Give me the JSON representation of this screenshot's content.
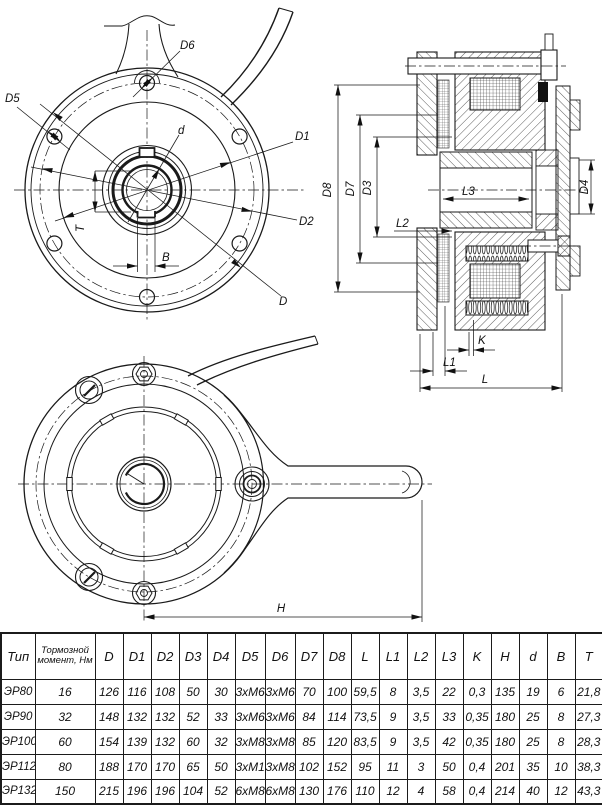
{
  "dim_labels": {
    "D": "D",
    "D1": "D1",
    "D2": "D2",
    "D3": "D3",
    "D4": "D4",
    "D5": "D5",
    "D6": "D6",
    "D7": "D7",
    "D8": "D8",
    "d": "d",
    "B": "B",
    "T": "T",
    "L": "L",
    "L1": "L1",
    "L2": "L2",
    "L3": "L3",
    "K": "K",
    "H": "H"
  },
  "table": {
    "col_headers": [
      "Тип",
      "Тормозной момент, Нм",
      "D",
      "D1",
      "D2",
      "D3",
      "D4",
      "D5",
      "D6",
      "D7",
      "D8",
      "L",
      "L1",
      "L2",
      "L3",
      "K",
      "H",
      "d",
      "B",
      "T"
    ],
    "rows": [
      {
        "type": "ЭР80",
        "values": [
          "16",
          "126",
          "116",
          "108",
          "50",
          "30",
          "3хМ6",
          "3хМ6",
          "70",
          "100",
          "59,5",
          "8",
          "3,5",
          "22",
          "0,3",
          "135",
          "19",
          "6",
          "21,8"
        ]
      },
      {
        "type": "ЭР90",
        "values": [
          "32",
          "148",
          "132",
          "132",
          "52",
          "33",
          "3хМ6",
          "3хМ6",
          "84",
          "114",
          "73,5",
          "9",
          "3,5",
          "33",
          "0,35",
          "180",
          "25",
          "8",
          "27,3"
        ]
      },
      {
        "type": "ЭР100",
        "values": [
          "60",
          "154",
          "139",
          "132",
          "60",
          "32",
          "3хМ8",
          "3хМ8",
          "85",
          "120",
          "83,5",
          "9",
          "3,5",
          "42",
          "0,35",
          "180",
          "25",
          "8",
          "28,3"
        ]
      },
      {
        "type": "ЭР112",
        "values": [
          "80",
          "188",
          "170",
          "170",
          "65",
          "50",
          "3хМ10",
          "3хМ8",
          "102",
          "152",
          "95",
          "11",
          "3",
          "50",
          "0,4",
          "201",
          "35",
          "10",
          "38,3"
        ]
      },
      {
        "type": "ЭР132",
        "values": [
          "150",
          "215",
          "196",
          "196",
          "104",
          "52",
          "6хМ8",
          "6хМ8",
          "130",
          "176",
          "110",
          "12",
          "4",
          "58",
          "0,4",
          "214",
          "40",
          "12",
          "43,3"
        ]
      }
    ]
  }
}
